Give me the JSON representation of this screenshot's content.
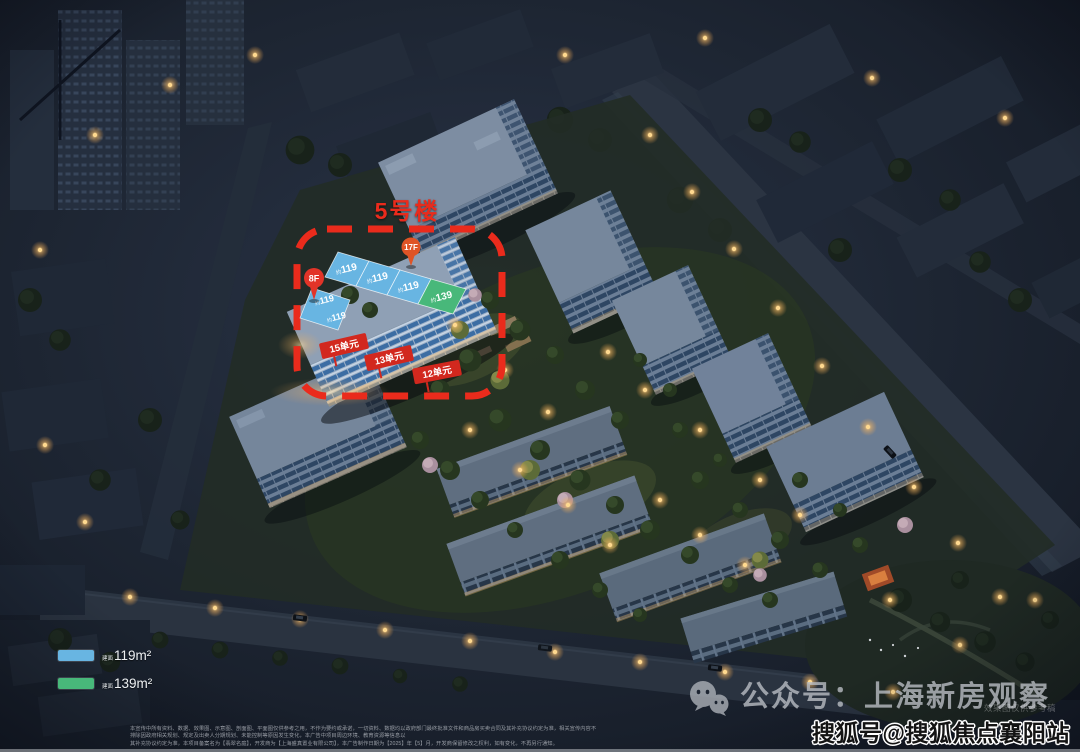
{
  "annotations": {
    "building_title": "5号楼",
    "pins": [
      {
        "label": "8F"
      },
      {
        "label": "17F"
      }
    ],
    "roof_panels": {
      "upper": [
        {
          "prefix": "约",
          "area": "119"
        },
        {
          "prefix": "约",
          "area": "119"
        },
        {
          "prefix": "约",
          "area": "119"
        },
        {
          "prefix": "约",
          "area": "139"
        }
      ],
      "left_wing": [
        {
          "prefix": "约",
          "area": "119"
        },
        {
          "prefix": "约",
          "area": "119"
        }
      ]
    },
    "unit_banners": [
      {
        "label": "15单元"
      },
      {
        "label": "13单元"
      },
      {
        "label": "12单元"
      }
    ],
    "colors": {
      "highlight_red": "#ea2b1c",
      "unit_banner_red": "#d2281e",
      "type119_blue": "#68b5e2",
      "type139_green": "#48b87a",
      "pin_8f_red": "#e23428",
      "pin_17f_orange": "#df5426",
      "watermark_gray": "#b6bac0"
    }
  },
  "legend": {
    "items": [
      {
        "swatch_color": "#68b5e2",
        "prefix": "建面",
        "label": "119m²"
      },
      {
        "swatch_color": "#48b87a",
        "prefix": "建面",
        "label": "139m²"
      }
    ]
  },
  "watermarks": {
    "wechat_text": "公众号：上海新房观察",
    "sohu_text": "搜狐号@搜狐焦点襄阳站",
    "render_note": "效果图仅供参考稿"
  },
  "disclaimer": {
    "line1": "本宣传中所有资料、数据、效果图、示意图、剖面图、平面图仅供参考之用，不作为要约或承诺，一切资料、数据均以政府部门最终批准文件和商品房买卖合同及其补充协议约定为准，相关宣传内容不排除因政府相关规划、规定及出卖人分期规划、未能控制等原因发生变化，本广告中项目周边环境、教育资源等信息以",
    "line2": "其补充协议约定为准，本项目备案名为【翡翠名庭】，开发商为【上海盛真置业有限公司】，本广告制作日期为【2025】年【5】月，开发商保留修改之权利，如有变化，不再另行通知。"
  }
}
